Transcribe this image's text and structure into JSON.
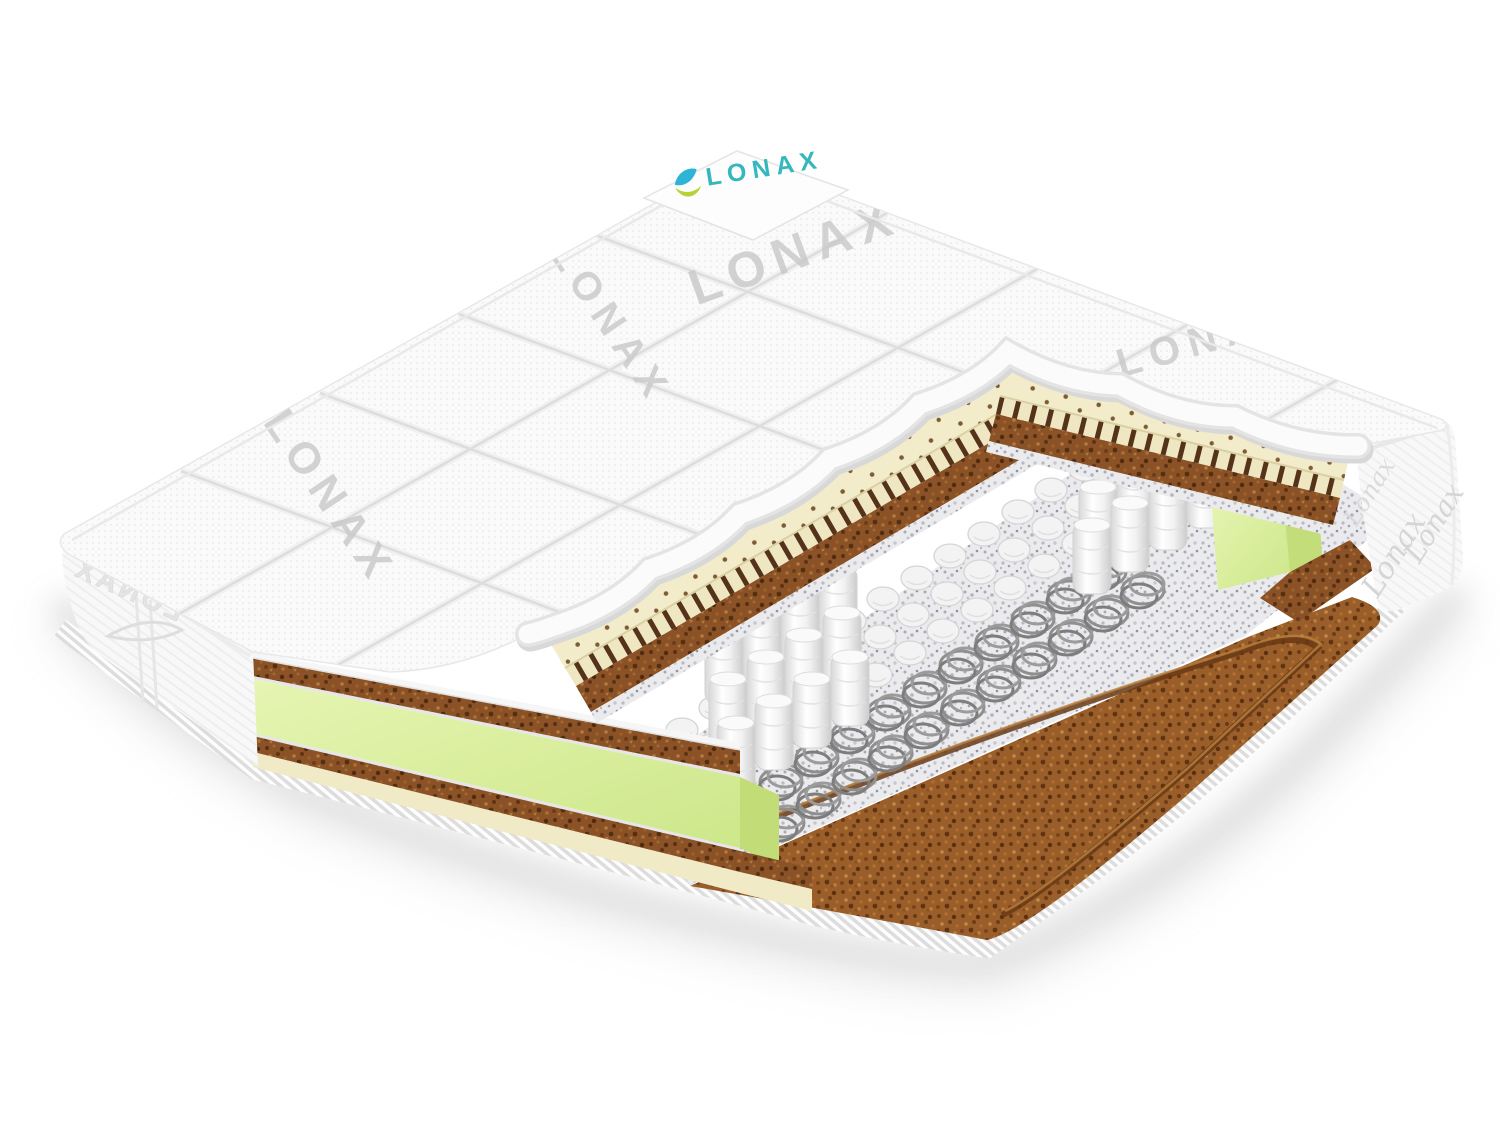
{
  "image": {
    "description": "3D cutaway render of a LONAX pocket-spring mattress on white background",
    "background": "#ffffff"
  },
  "brand": {
    "name": "LONAX",
    "corner_label_text": "LONAX",
    "watermark_text": "LONAX",
    "side_embossed_text": "LONAX",
    "side_script_text": "Lonax",
    "logo_color": "#35b7bd"
  },
  "colors": {
    "quilt_fabric": "#fafafa",
    "quilt_seam": "#dcdcdc",
    "quilt_watermark": "#c8c8c8",
    "leaf_blue": "#2fb4d8",
    "leaf_green": "#b5d333",
    "latex": "#f2ecca",
    "latex_perforation": "#6f4b24",
    "coconut_coir": "#8a5226",
    "bottom_coir": "#9a5e2b",
    "felt": "#ebebed",
    "foam_frame": "#d8eea0",
    "foam_frame_shade": "#c3dd7b",
    "spring_pocket_fabric": "#f4f4f4",
    "spring_coil_wire": "#8f8f8f",
    "border_tape": "#f3f3f3",
    "side_fabric": "#f8f8f8",
    "side_script": "#d5d5d5",
    "shadow": "#c8c8c8"
  },
  "layers": [
    {
      "name": "quilted-cover",
      "color": "#fafafa"
    },
    {
      "name": "perforated-latex",
      "color": "#f2ecca"
    },
    {
      "name": "coconut-coir",
      "color": "#8a5226"
    },
    {
      "name": "felt",
      "color": "#ebebed"
    },
    {
      "name": "pocket-springs",
      "color": "#f4f4f4"
    },
    {
      "name": "open-coils",
      "color": "#8f8f8f"
    },
    {
      "name": "foam-perimeter",
      "color": "#d8eea0"
    },
    {
      "name": "bottom-coir-panel",
      "color": "#9a5e2b"
    },
    {
      "name": "border-tape",
      "color": "#f3f3f3"
    }
  ]
}
